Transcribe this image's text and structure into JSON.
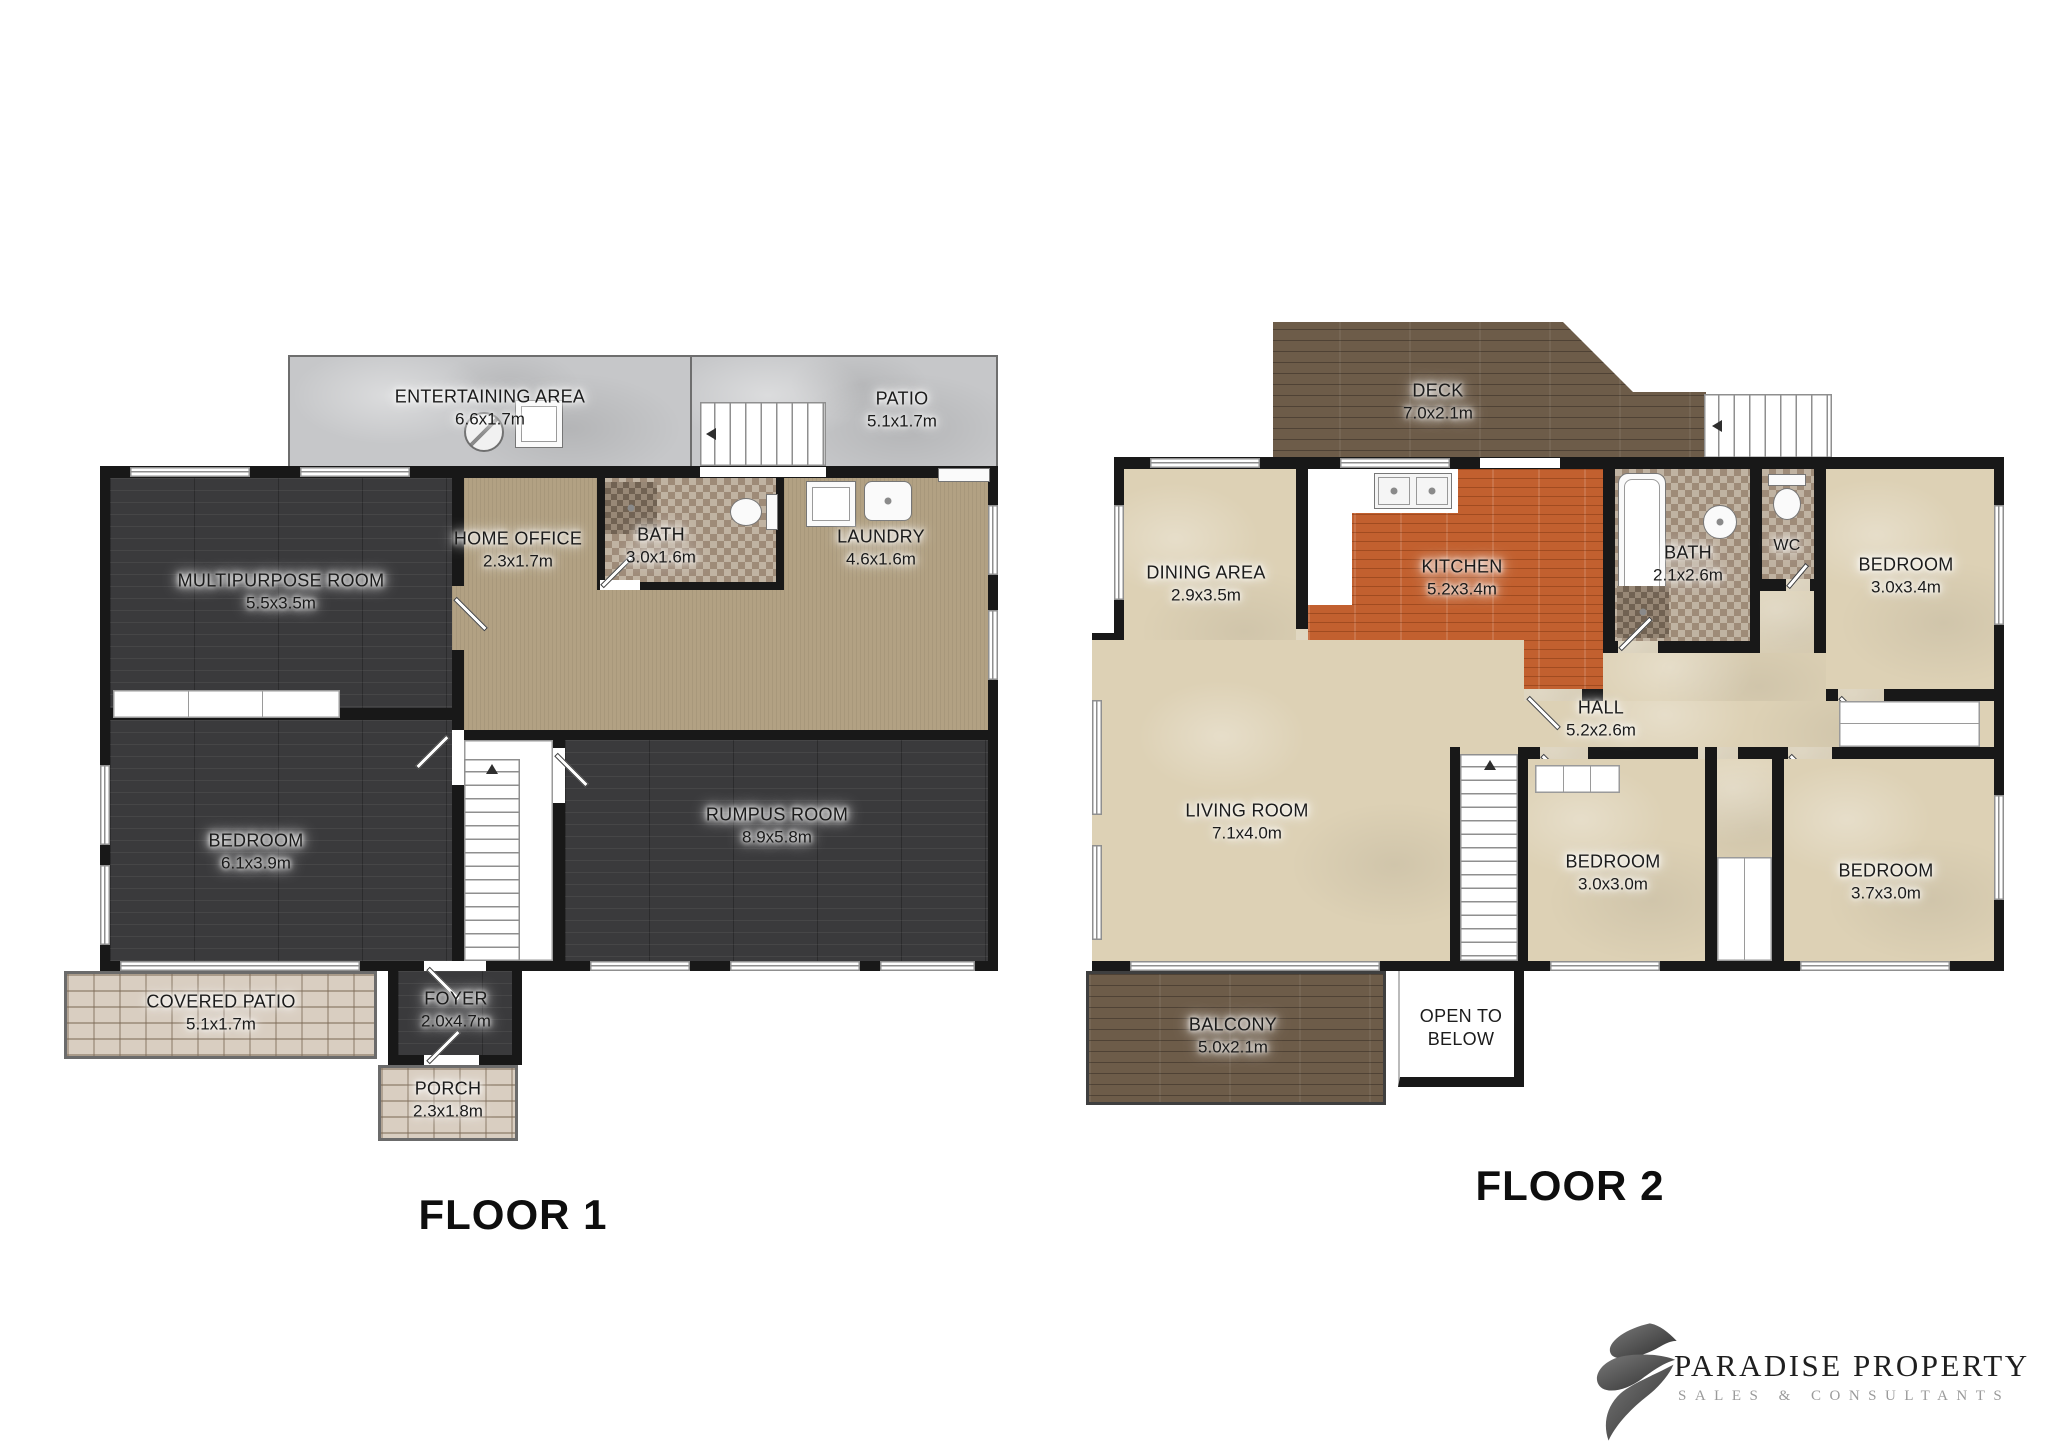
{
  "floor1": {
    "title": "FLOOR 1",
    "rooms": {
      "entertaining": {
        "name": "ENTERTAINING AREA",
        "dims": "6.6x1.7m"
      },
      "patio": {
        "name": "PATIO",
        "dims": "5.1x1.7m"
      },
      "multipurpose": {
        "name": "MULTIPURPOSE ROOM",
        "dims": "5.5x3.5m"
      },
      "home_office": {
        "name": "HOME OFFICE",
        "dims": "2.3x1.7m"
      },
      "bath": {
        "name": "BATH",
        "dims": "3.0x1.6m"
      },
      "laundry": {
        "name": "LAUNDRY",
        "dims": "4.6x1.6m"
      },
      "bedroom": {
        "name": "BEDROOM",
        "dims": "6.1x3.9m"
      },
      "rumpus": {
        "name": "RUMPUS ROOM",
        "dims": "8.9x5.8m"
      },
      "covered_patio": {
        "name": "COVERED PATIO",
        "dims": "5.1x1.7m"
      },
      "foyer": {
        "name": "FOYER",
        "dims": "2.0x4.7m"
      },
      "porch": {
        "name": "PORCH",
        "dims": "2.3x1.8m"
      }
    }
  },
  "floor2": {
    "title": "FLOOR 2",
    "rooms": {
      "deck": {
        "name": "DECK",
        "dims": "7.0x2.1m"
      },
      "dining": {
        "name": "DINING AREA",
        "dims": "2.9x3.5m"
      },
      "kitchen": {
        "name": "KITCHEN",
        "dims": "5.2x3.4m"
      },
      "bath": {
        "name": "BATH",
        "dims": "2.1x2.6m"
      },
      "wc": {
        "name": "WC"
      },
      "bedroom_top": {
        "name": "BEDROOM",
        "dims": "3.0x3.4m"
      },
      "hall": {
        "name": "HALL",
        "dims": "5.2x2.6m"
      },
      "living": {
        "name": "LIVING ROOM",
        "dims": "7.1x4.0m"
      },
      "bedroom_mid": {
        "name": "BEDROOM",
        "dims": "3.0x3.0m"
      },
      "bedroom_right": {
        "name": "BEDROOM",
        "dims": "3.7x3.0m"
      },
      "balcony": {
        "name": "BALCONY",
        "dims": "5.0x2.1m"
      },
      "open_below": {
        "name": "OPEN TO BELOW"
      }
    }
  },
  "logo": {
    "brand": "PARADISE PROPERTY",
    "tagline": "SALES & CONSULTANTS"
  },
  "colors": {
    "wall": "#181818",
    "concrete": "#c6c7c9",
    "dark_wood": "#3a3a3c",
    "tan_floor": "#b2a183",
    "brick": "#d9cec1",
    "deck_wood": "#6d5c49",
    "kitchen_wood": "#c2602f",
    "carpet": "#ddd1b5",
    "tile": "#b3a492"
  },
  "icons": {
    "bbq-icon": "circle with diagonal line",
    "table-icon": "square outline",
    "stairs-arrow": "direction triangle",
    "washer-icon": "square with inner square",
    "laundry-sink-icon": "rounded square with dot",
    "toilet-icon": "oval bowl with tank",
    "bathtub-icon": "rounded rectangle tub",
    "basin-icon": "circle with dot",
    "shower-icon": "dark tile square with drain",
    "kitchen-sink-icon": "double bowl sink",
    "stove-icon": "dark square with 4 burners",
    "fridge-icon": "white rectangle with shine"
  }
}
